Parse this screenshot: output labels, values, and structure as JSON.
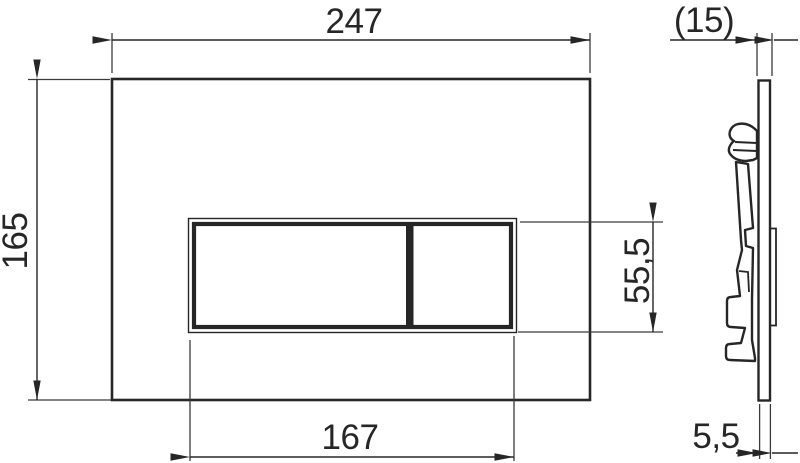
{
  "drawing": {
    "type": "technical-dimension-drawing",
    "subject": "wc-flush-plate-two-button",
    "views": {
      "front": {
        "dimensions": {
          "overall_width": "247",
          "overall_height": "165",
          "button_width": "167",
          "button_height": "55,5"
        }
      },
      "side": {
        "dimensions": {
          "overall_depth": "(15)",
          "plate_thickness": "5,5"
        }
      }
    },
    "colors": {
      "line": "#262626",
      "thin_line": "#3a3a3a",
      "background": "#ffffff"
    }
  }
}
